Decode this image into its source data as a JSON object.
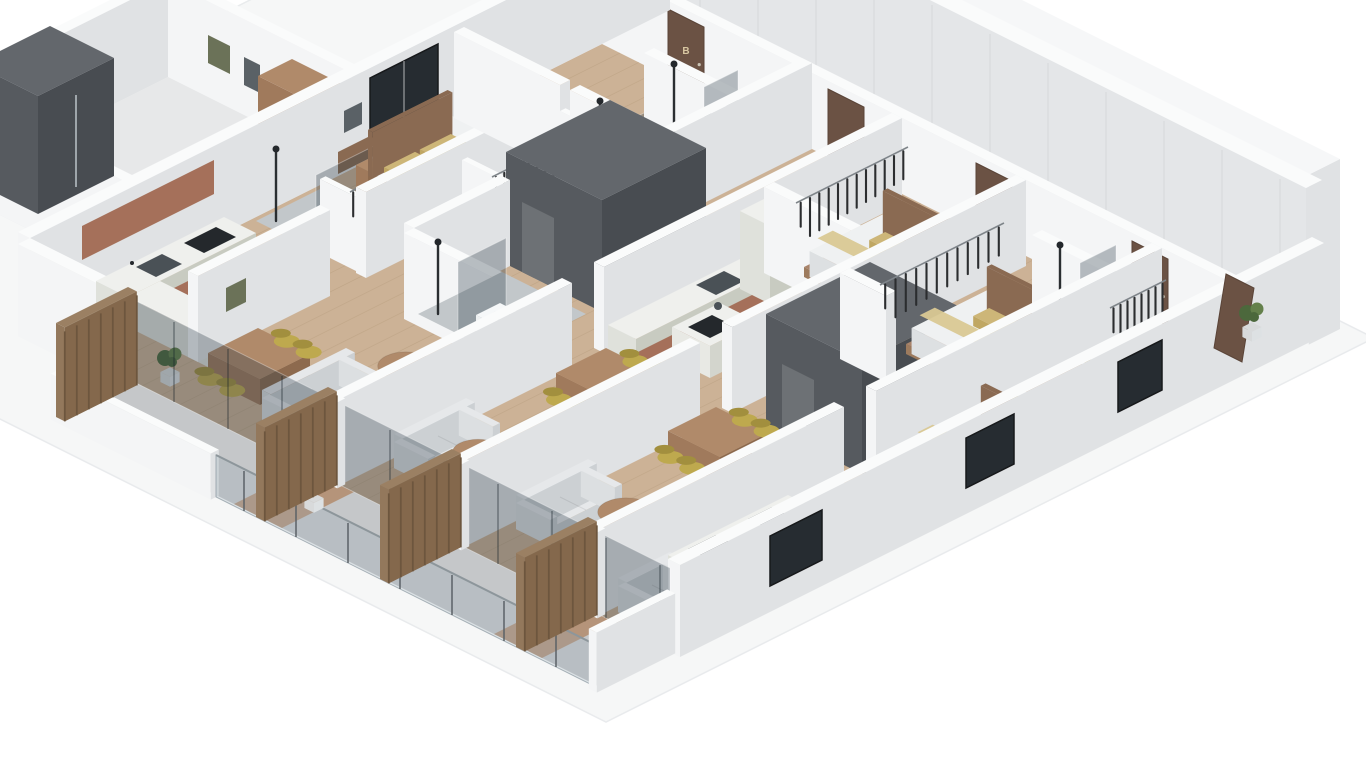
{
  "title": "Isometric 3D apartment floor plan — cutaway render",
  "doors": {
    "unit_b_label": "B",
    "unit_d_label": "D"
  },
  "building": {
    "view": "isometric cutaway 3D floor plan, rotated 45 degrees on white background",
    "corridor_position": "upper-right edge with tall panelled wall and elevators",
    "balcony_position": "lower-left edge with glass balustrades and timber slat screens",
    "units_visible": 5,
    "door_letters_visible": [
      "B",
      "D"
    ],
    "floor_finishes": [
      "light oak plank flooring",
      "concrete corridor and balconies",
      "grey tiled shower zones"
    ]
  },
  "rooms": [
    {
      "name": "corridor",
      "items": [
        "elevator",
        "entry-door-B",
        "entry-door-D",
        "open-entry-door",
        "potted-plant"
      ]
    },
    {
      "name": "unit-b-kitchen",
      "items": [
        "l-shaped-counter",
        "terracotta-cabinet-fronts",
        "sink",
        "cooktop",
        "tall-cabinet",
        "wood-upper-band"
      ]
    },
    {
      "name": "unit-b-bedroom",
      "items": [
        "double-bed",
        "olive-pillows",
        "black-frame-window",
        "headboard-shelf-band",
        "nightstand",
        "wall-art"
      ]
    },
    {
      "name": "unit-b-walk-in-closet",
      "items": [
        "clothes-rail",
        "hanging-clothes"
      ]
    },
    {
      "name": "unit-b-shower-room",
      "items": [
        "walk-in-shower",
        "smoked-glass-screen",
        "black-rain-shower"
      ]
    },
    {
      "name": "unit-b-living-dining",
      "items": [
        "corner-sofa",
        "round-coffee-table",
        "dining-table",
        "four-olive-chairs",
        "tv-console",
        "tv",
        "potted-plant",
        "washing-machine-in-timber-niche",
        "balcony-glazing"
      ]
    },
    {
      "name": "center-unit-living",
      "items": [
        "two-facing-sofas",
        "round-coffee-table",
        "media-wall-with-tv",
        "dining-table",
        "four-olive-chairs",
        "kitchen-island-with-hob",
        "counter-with-sink",
        "tall-fridge-cabinet",
        "planter"
      ]
    },
    {
      "name": "right-bedroom-1",
      "items": [
        "double-bed",
        "olive-throw",
        "wardrobe-with-hanging-clothes"
      ]
    },
    {
      "name": "right-bedroom-2",
      "items": [
        "double-bed",
        "olive-throw",
        "wardrobe-with-hanging-clothes",
        "ensuite-shower"
      ]
    },
    {
      "name": "ensuite-bathrooms",
      "items": [
        "tiled-shower",
        "glass-panel",
        "toilet",
        "vanity-sink",
        "black-tapware"
      ]
    },
    {
      "name": "bottom-unit",
      "items": [
        "kitchen-counter-with-hob-and-sink",
        "double-bed",
        "dining-table",
        "olive-chairs",
        "wardrobe",
        "potted-plant"
      ]
    },
    {
      "name": "stair-core-1",
      "items": [
        "dark-grey-shaft"
      ]
    },
    {
      "name": "stair-core-2",
      "items": [
        "dark-grey-shaft"
      ]
    },
    {
      "name": "top-wing",
      "items": [
        "elevator-shaft",
        "wall-art",
        "timber-cabinet"
      ]
    },
    {
      "name": "balconies",
      "items": [
        "glass-balustrade",
        "white-parapet",
        "timber-slat-screens",
        "deck-strips",
        "potted-plants"
      ]
    }
  ],
  "palette": {
    "apron": "#f6f7f7",
    "apron_edge": "#e9ebed",
    "wall_top": "#fafbfb",
    "wall_light": "#f4f5f6",
    "wall_mid": "#e0e2e4",
    "backwall_face": "#e4e6e8",
    "backwall_top": "#f6f7f8",
    "corridor": "#b6b9bb",
    "balcony": "#c5c7c9",
    "floor_gray": "#e7e8e9",
    "wood": "#ccb296",
    "wood_line": "#a98f6e",
    "deck": "#b5947a",
    "tile": "#c2c7ca",
    "core": "#565a5f",
    "core_dark": "#484c51",
    "core_top": "#63676c",
    "core_door": "#6d7175",
    "elevator_dark": "#3d4145",
    "elevator_door": "#9fa6ab",
    "cabinet": "#dfe1db",
    "cabinet_side": "#c8cbc1",
    "counter_top": "#eff0ed",
    "island": "#e8e9e4",
    "island_side": "#d3d5cd",
    "table_wood": "#b18a66",
    "table_side": "#96744f",
    "wood_furn_top": "#b08a6a",
    "wood_furn": "#a07a5c",
    "wood_furn_side": "#8d6a4e",
    "wood_accent_top": "#b08672",
    "wood_accent": "#a5705a",
    "wood_accent_side": "#8f5f4b",
    "wood_band": "#8a6a52",
    "bed_top": "#eff1f2",
    "bed_side": "#dde0e2",
    "bed_side2": "#d2d6d8",
    "bed_frame_top": "#a9846b",
    "bed_frame": "#9d7b5e",
    "bed_frame_side": "#8a6a52",
    "pillow": "#cdb678",
    "pillow_side": "#c0a763",
    "pillow_dark": "#b29754",
    "pillow_light": "#d9c893",
    "sofa": "#e6e8ea",
    "sofa_side": "#dcdfe1",
    "sofa_dark": "#ccd0d3",
    "chair": "#bea94e",
    "chair_dark": "#a28f3e",
    "fixture_top": "#f6f8f9",
    "fixture": "#eef1f2",
    "fixture_side": "#dde1e3",
    "appliance": "#24282c",
    "steel": "#4a5156",
    "clothes": "#2b2d2f",
    "rail": "#7f858a",
    "door_brown": "#6b5244",
    "door_dark": "#5a4438",
    "letter": "#d8c7a2",
    "slat_top": "#9b8063",
    "slat": "#93785c",
    "slat_side": "#84684c",
    "slat_stripe": "#6d563e",
    "plant": "#4c683c",
    "plant_light": "#64804b",
    "pot": "#d8dadb",
    "washer_top": "#f0f2f3",
    "washer": "#e8ebec",
    "washer_side": "#d9dde0",
    "washer_door": "#34383c",
    "window_dark": "#262c31",
    "glass": "rgba(44,60,70,0.32)",
    "glass_light": "rgba(150,168,178,0.28)",
    "art1": "#6b7258",
    "art2": "#5a6166"
  }
}
